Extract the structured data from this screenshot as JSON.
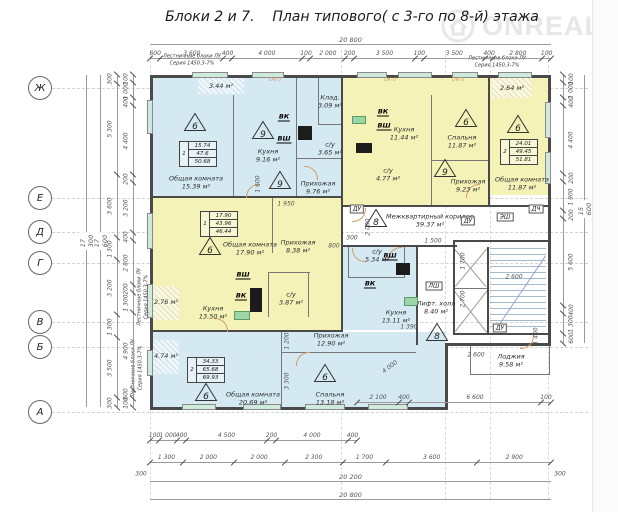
{
  "title": "Блоки 2 и 7.    План типового( с 3-го по 8-й) этажа",
  "watermark": {
    "brand": "ONREALT"
  },
  "grid_rows": {
    "r1": "Ж",
    "r2": "Е",
    "r3": "Д",
    "r4": "Г",
    "r5": "В",
    "r6": "Б",
    "r7": "А"
  },
  "notes": {
    "line1": "Лестничные блоки ЛУ",
    "line2": "Серия 1450.3-7%",
    "ok": "ОК-3"
  },
  "tech": {
    "vk": "ВК",
    "vsh": "ВШ",
    "du": "ДУ",
    "esh": "ЭШ",
    "lsh": "ЛШ",
    "dch": "ДЧ"
  },
  "apartments": {
    "t1": {
      "num": "1",
      "living": "15.74",
      "area": "47.6",
      "total": "50.68"
    },
    "t2": {
      "num": "2",
      "living": "24.01",
      "area": "49.45",
      "total": "51.81"
    },
    "t3": {
      "num": "1",
      "living": "17.90",
      "area": "43.96",
      "total": "46.44"
    },
    "t4": {
      "num": "2",
      "living": "34.33",
      "area": "65.68",
      "total": "69.93"
    }
  },
  "triangles": {
    "tri1": "6",
    "tri2": "9",
    "tri3": "9",
    "tri4": "6",
    "tri5": "9",
    "tri6": "6",
    "tri7": "6",
    "tri8": "8",
    "tri9": "8",
    "tri10": "6",
    "tri11": "6"
  },
  "rooms": {
    "liv1": {
      "name": "Общая комната",
      "area": "15.39 м²"
    },
    "kit1": {
      "name": "Кухня",
      "area": "9.16 м²"
    },
    "hall1": {
      "name": "Прихожая",
      "area": "9.76 м²"
    },
    "wc1": {
      "name": "с/у",
      "area": "3.65 м²"
    },
    "stor1": {
      "name": "Клад.",
      "area": "3.09 м²"
    },
    "balc1": {
      "area": "3.44 м²"
    },
    "kit2": {
      "name": "Кухня",
      "area": "11.44 м²"
    },
    "bed2": {
      "name": "Спальня",
      "area": "11.87 м²"
    },
    "hall2": {
      "name": "Прихожая",
      "area": "9.23 м²"
    },
    "wc2": {
      "name": "с/у",
      "area": "4.77 м²"
    },
    "liv3": {
      "name": "Общая комната",
      "area": "11.87 м²"
    },
    "balc3": {
      "area": "2.64 м²"
    },
    "liv4": {
      "name": "Общая комната",
      "area": "17.90 м²"
    },
    "hall4": {
      "name": "Прихожая",
      "area": "8.38 м²"
    },
    "kit4": {
      "name": "Кухня",
      "area": "13.50 м²"
    },
    "wc4": {
      "name": "с/у",
      "area": "3.87 м²"
    },
    "balc4": {
      "area": "2.76 м²"
    },
    "corr": {
      "name": "Межквартирный коридор",
      "area": "39.37 м²"
    },
    "wc5": {
      "name": "с/у",
      "area": "5.34 м²"
    },
    "kit5": {
      "name": "Кухня",
      "area": "13.11 м²"
    },
    "hall5": {
      "name": "Прихожая",
      "area": "12.90 м²"
    },
    "liv5": {
      "name": "Общая комната",
      "area": "20.69 м²"
    },
    "bed5": {
      "name": "Спальня",
      "area": "13.18 м²"
    },
    "balc5": {
      "area": "4.74 м²"
    },
    "lift": {
      "name": "Лифт. холл",
      "area": "8.40 м²"
    },
    "loggia": {
      "name": "Лоджия",
      "area": "9.58 м²"
    }
  },
  "dims": {
    "top_total": "20 800",
    "top_chain": [
      "600",
      "3 600",
      "400",
      "4 000",
      "100",
      "2 000",
      "200",
      "3 500",
      "100",
      "3 500",
      "400",
      "2 800",
      "100"
    ],
    "left_total_outer": "17 300",
    "left_total_inner": "17 600",
    "left_chain": [
      "300",
      "5 300",
      "3 600",
      "1 300",
      "3 200",
      "1 300",
      "3 500",
      "300"
    ],
    "left_chain2": [
      "100",
      "1 000",
      "400",
      "4 400",
      "200",
      "3 200",
      "400",
      "2 800",
      "200",
      "1 300",
      "4 900",
      "600",
      "100"
    ],
    "right_chain": [
      "100",
      "1 000",
      "400",
      "4 400",
      "200",
      "1 900",
      "200",
      "5 600",
      "400",
      "1 300",
      "600"
    ],
    "right_total": "15 600",
    "bottom_chain1": [
      "100",
      "1 000",
      "400",
      "4 500",
      "200",
      "4 000",
      "400"
    ],
    "bottom_mid": [
      "2 100",
      "400",
      "6 600",
      "100"
    ],
    "bottom_chain2": [
      "1 300",
      "2 000",
      "2 000",
      "2 300",
      "1 700",
      "3 600",
      "2 900"
    ],
    "bottom_total": "20 200",
    "bottom_total2": "20 800",
    "end300": "300",
    "inner": {
      "i1": "1 950",
      "i2": "1 600",
      "i3": "2 000",
      "i4": "300",
      "i5": "1 500",
      "i6": "1 700",
      "i7": "2 700",
      "i8": "2 600",
      "i9": "2 600",
      "i10": "4 000",
      "i11": "1 390",
      "i12": "1 200",
      "i13": "3 300",
      "i14": "1 400",
      "i15": "800"
    }
  }
}
